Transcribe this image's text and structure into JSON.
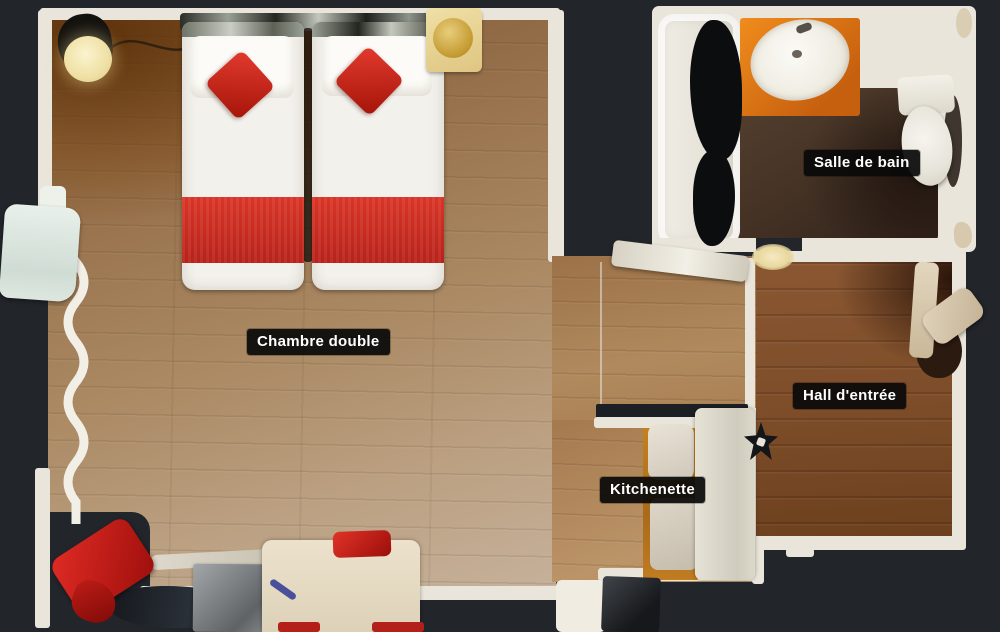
{
  "page": {
    "type": "3d-tour-floor-plan-top-view",
    "background_color": "#22252a"
  },
  "rooms": [
    {
      "id": "chambre-double",
      "label": "Chambre double"
    },
    {
      "id": "salle-de-bain",
      "label": "Salle de bain"
    },
    {
      "id": "hall-entree",
      "label": "Hall d'entrée"
    },
    {
      "id": "kitchenette",
      "label": "Kitchenette"
    }
  ],
  "palette": {
    "background": "#22252a",
    "label_background": "#0d0d0d",
    "label_text": "#ffffff",
    "wall_white": "#e9e5da",
    "bedroom_floor": "#a8805a",
    "corridor_floor": "#a57a4e",
    "hall_floor": "#7c4e2b",
    "bathroom_floor": "#433126",
    "kitchen_cabinet_wood": "#b97e33",
    "bed_linen_white": "#f3f1ec",
    "accent_red": "#d3302a",
    "vanity_orange": "#e07a1a"
  }
}
